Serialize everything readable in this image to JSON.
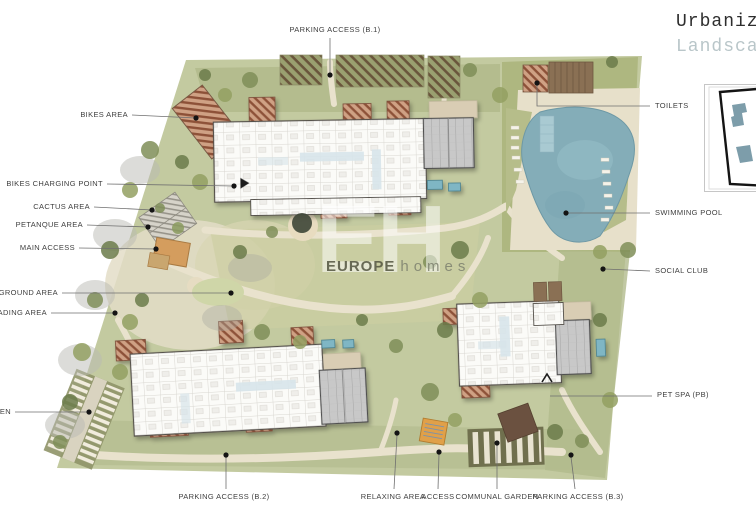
{
  "title": {
    "line1": "Urbanization",
    "line2": "Landscaping"
  },
  "watermark": {
    "monogram": "EH",
    "brand_primary": "EUROPE",
    "brand_secondary": "homes"
  },
  "labels": {
    "parking_access_b1": "PARKING ACCESS (B.1)",
    "bikes_area": "BIKES AREA",
    "bikes_charging_point": "BIKES CHARGING POINT",
    "cactus_area": "CACTUS AREA",
    "petanque_area": "PETANQUE AREA",
    "main_access": "MAIN ACCESS",
    "playground_area": "PLAYGROUND AREA",
    "reading_area": "READING AREA",
    "garden": "GARDEN",
    "toilets": "TOILETS",
    "swimming_pool": "SWIMMING POOL",
    "social_club": "SOCIAL CLUB",
    "pet_spa": "PET SPA (PB)",
    "parking_access_b2": "PARKING ACCESS (B.2)",
    "relaxing_area": "RELAXING AREA",
    "access": "ACCESS",
    "communal_garden": "COMMUNAL GARDEN",
    "parking_access_b3": "PARKING ACCESS (B.3)"
  },
  "colors": {
    "site_green": "#c3caa0",
    "pool_water": "#84adb8",
    "inset_building_teal": "#7d9daa",
    "title_secondary": "#b9c6c9",
    "roof_hatch_brown": "#8d5138"
  }
}
